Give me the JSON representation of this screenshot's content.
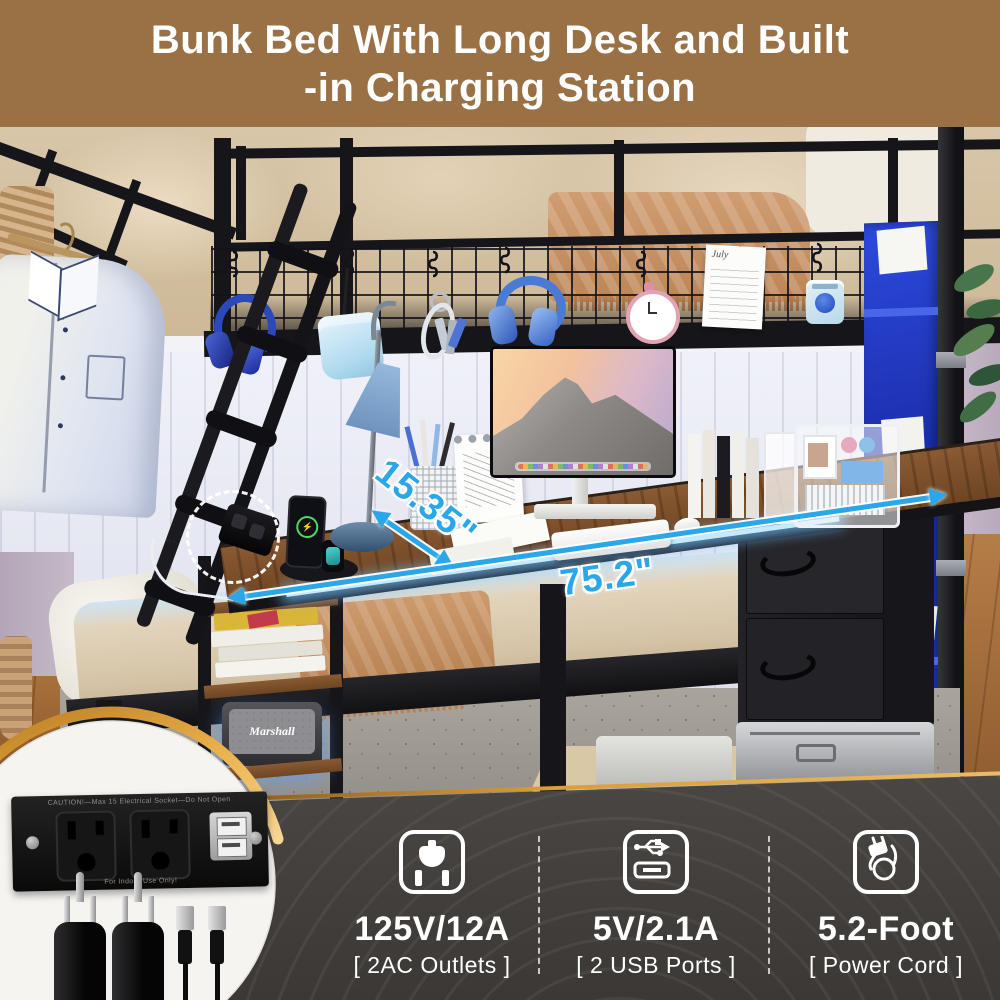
{
  "banner": {
    "title_line1": "Bunk Bed With Long Desk and Built",
    "title_line2": "-in Charging Station",
    "bg_color": "#997145",
    "text_color": "#ffffff"
  },
  "dimensions": {
    "depth_label": "15.35\"",
    "length_label": "75.2\"",
    "arrow_color": "#2aa7e9"
  },
  "inset": {
    "caution_text": "CAUTION!—Max 15 Electrical Socket—Do Not Open",
    "indoor_text": "For Indoor Use Only!"
  },
  "scene": {
    "speaker_brand": "Marshall",
    "calendar_month": "July",
    "phone_charging_icon": "⚡"
  },
  "specs": {
    "items": [
      {
        "icon": "power-outlet-icon",
        "value": "125V/12A",
        "caption": "[ 2AC Outlets ]"
      },
      {
        "icon": "usb-icon",
        "value": "5V/2.1A",
        "caption": "[ 2 USB Ports ]"
      },
      {
        "icon": "power-cord-icon",
        "value": "5.2-Foot",
        "caption": "[ Power Cord ]"
      }
    ]
  }
}
